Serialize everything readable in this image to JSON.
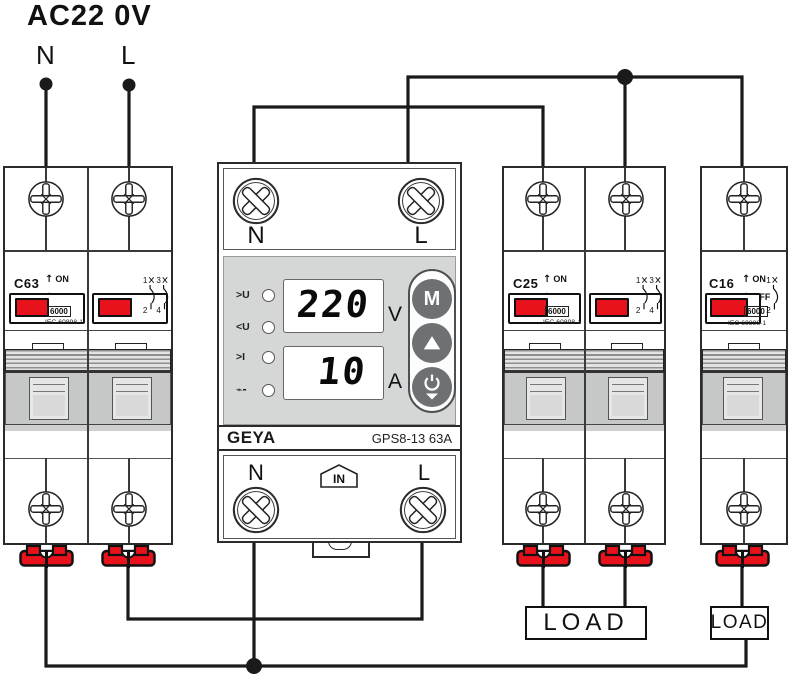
{
  "title": "AC22 0V",
  "supply": {
    "n": "N",
    "l": "L"
  },
  "colors": {
    "handle_red": "#e8121c",
    "wire": "#1a1a1a",
    "display_panel": "#d5d6d6",
    "button_gray": "#6d7173"
  },
  "protector": {
    "top": {
      "n": "N",
      "l": "L"
    },
    "bottom": {
      "n": "N",
      "l": "L",
      "in_label": "IN"
    },
    "leds": [
      ">U",
      "<U",
      ">I",
      "⌁-"
    ],
    "display": {
      "voltage": "220",
      "voltage_unit": "V",
      "current": "10",
      "current_unit": "A"
    },
    "buttons": {
      "mode": "M"
    },
    "brand": "GEYA",
    "model": "GPS8-13 63A"
  },
  "breakers": {
    "left": {
      "model": "C63",
      "voltage": "400V~",
      "on": "ON",
      "off": "OFF",
      "rating": "6000",
      "standard": "IEC 60898-1",
      "poles": [
        "1",
        "3",
        "2",
        "4"
      ]
    },
    "right": {
      "model": "C25",
      "voltage": "400V~",
      "on": "ON",
      "off": "OFF",
      "rating": "6000",
      "standard": "IEC 60898-1",
      "poles": [
        "1",
        "3",
        "2",
        "4"
      ]
    },
    "single": {
      "model": "C16",
      "voltage": "230V~",
      "on": "ON",
      "off": "OFF",
      "rating": "6000",
      "standard": "IEC 60898-1",
      "poles": [
        "1",
        "2"
      ]
    }
  },
  "loads": {
    "load1": "LOAD",
    "load2": "LOAD"
  }
}
